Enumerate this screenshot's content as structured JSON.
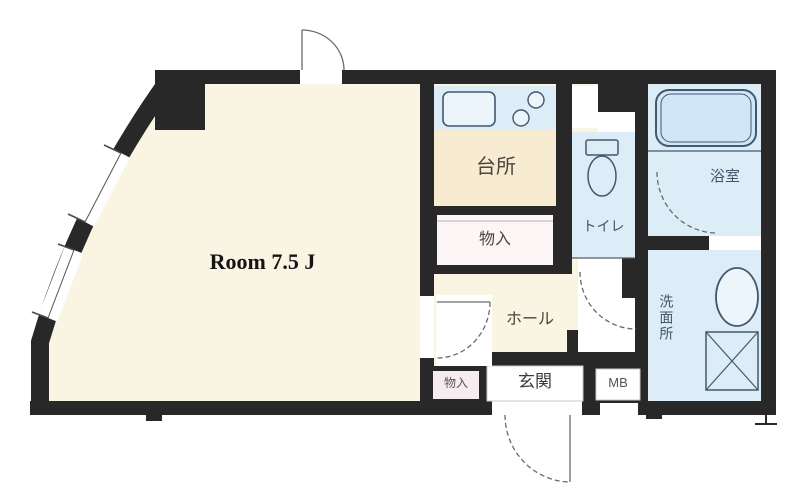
{
  "plan": {
    "room": {
      "label": "Room 7.5 J",
      "area_tatami": 7.5
    },
    "kitchen": {
      "label": "台所"
    },
    "storage": {
      "label": "物入"
    },
    "toilet": {
      "label": "トイレ"
    },
    "bathroom": {
      "label": "浴室"
    },
    "washroom": {
      "label": "洗面所"
    },
    "hall": {
      "label": "ホール"
    },
    "entrance": {
      "label": "玄関"
    },
    "meter_box": {
      "label": "MB"
    },
    "entrance_storage": {
      "label": "物入"
    }
  },
  "colors": {
    "wall": "#282828",
    "cream": "#faf4e3",
    "kitchen_floor": "#f7ebd2",
    "wet": "#dcedf8",
    "tub": "#cfe7f6",
    "closet": "#fcf6f7",
    "pink": "#f6ecef",
    "white": "#ffffff",
    "fixture": "#41586e",
    "arc": "#6a6a6a",
    "label_dark": "#4a453e",
    "label_wet": "#43566a"
  }
}
